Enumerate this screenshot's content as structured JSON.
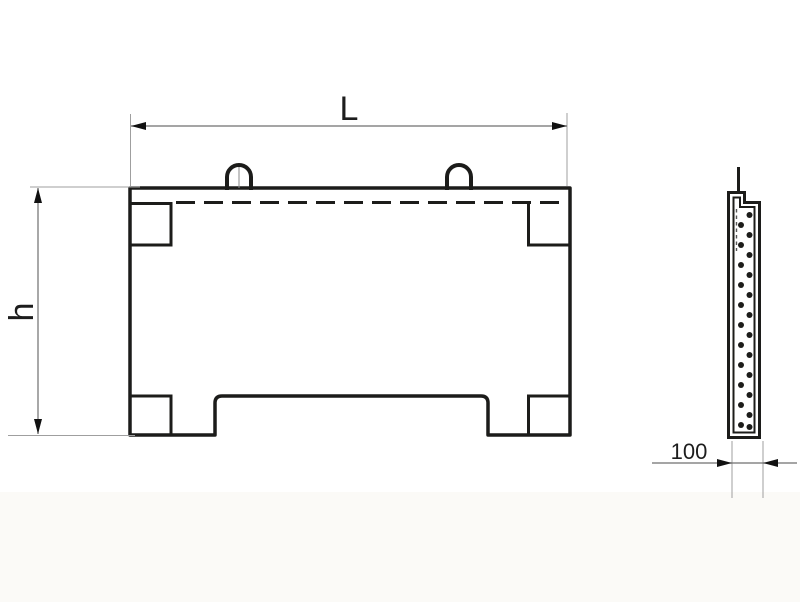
{
  "drawing": {
    "type": "engineering-drawing",
    "subject": "reinforced concrete panel, front view and side section view",
    "views": {
      "front_view": "panel with two lifting loops, dashed reinforcement line, corner notches and bottom central cutout",
      "side_view": "thin vertical section with inner liner and zigzag rebar dots"
    }
  },
  "dimensions": {
    "length_label": "L",
    "height_label": "h",
    "thickness_label": "100"
  },
  "side_view": {
    "rebar_dot_rows": 11
  },
  "colors": {
    "background": "#ffffff",
    "line": "#1c1c1a",
    "dimension_line": "#6f6f6f",
    "extension_line": "#9f9f9f",
    "text": "#1d1d1d"
  }
}
